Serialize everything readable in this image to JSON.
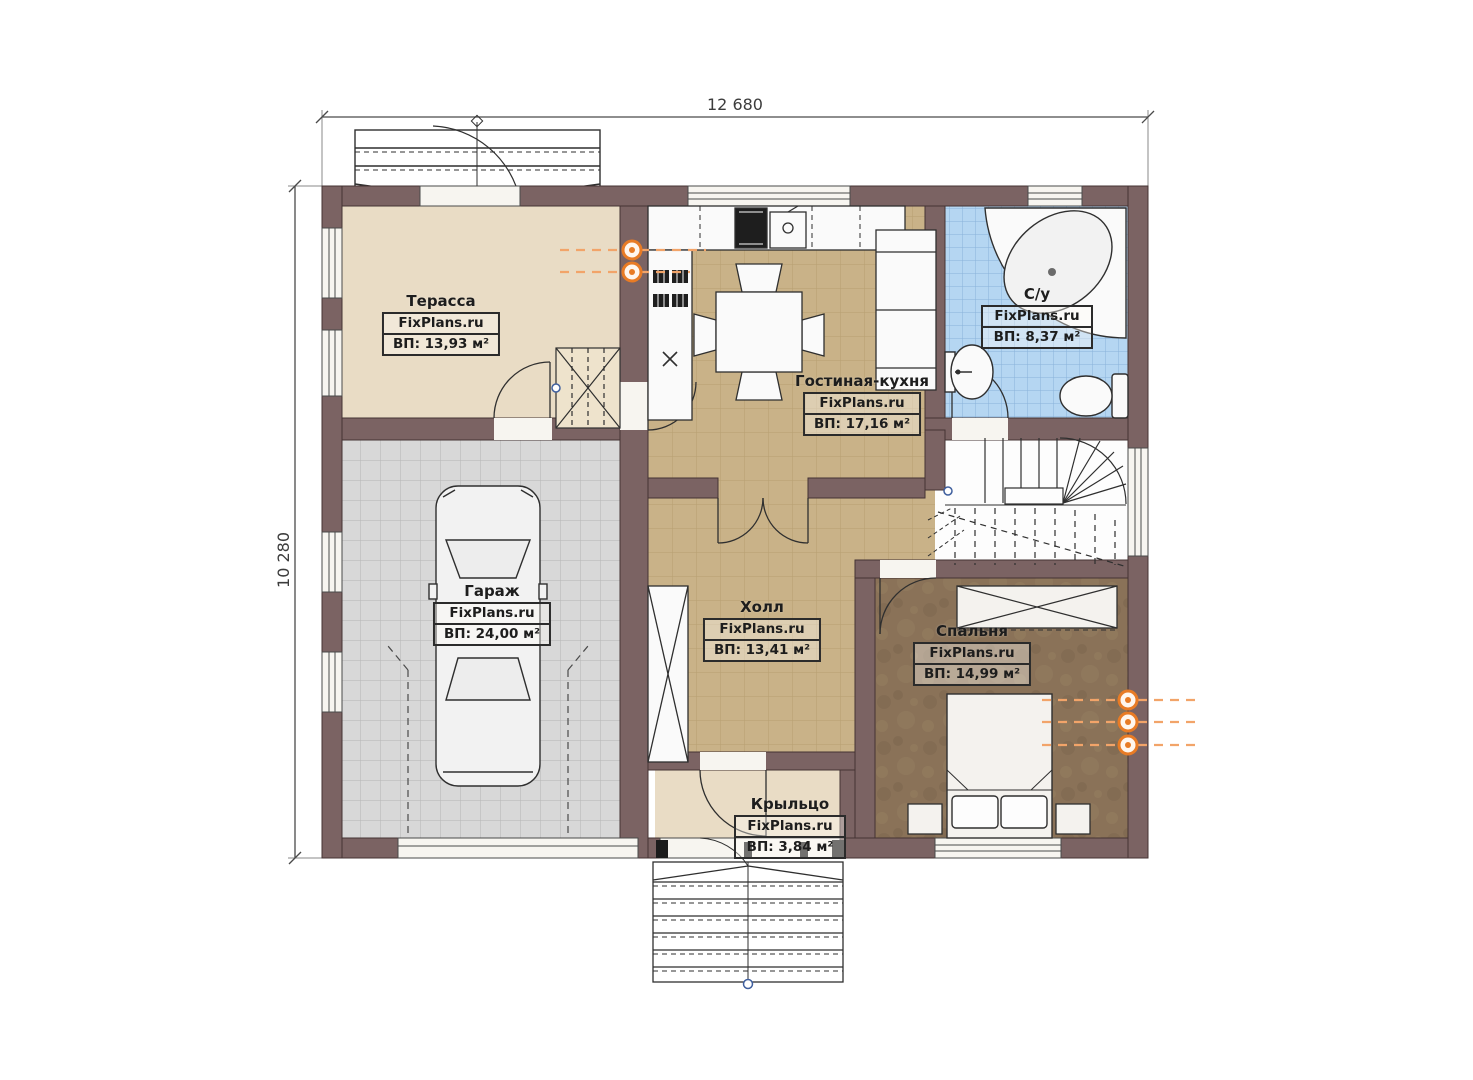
{
  "plan": {
    "type": "first-floor-plan",
    "dimensions": {
      "width_label": "12 680",
      "height_label": "10 280"
    },
    "rooms": [
      {
        "name": "Терасса",
        "brand": "FixPlans.ru",
        "area": "ВП: 13,93 м²"
      },
      {
        "name": "Гостиная-кухня",
        "brand": "FixPlans.ru",
        "area": "ВП: 17,16 м²"
      },
      {
        "name": "С/у",
        "brand": "FixPlans.ru",
        "area": "ВП: 8,37 м²"
      },
      {
        "name": "Гараж",
        "brand": "FixPlans.ru",
        "area": "ВП: 24,00 м²"
      },
      {
        "name": "Холл",
        "brand": "FixPlans.ru",
        "area": "ВП: 13,41 м²"
      },
      {
        "name": "Спальня",
        "brand": "FixPlans.ru",
        "area": "ВП: 14,99 м²"
      },
      {
        "name": "Крыльцо",
        "brand": "FixPlans.ru",
        "area": "ВП: 3,84 м²"
      }
    ],
    "colors": {
      "wall": "#7b6363",
      "floor_wood": "#c9b288",
      "floor_terrace": "#e9dcc5",
      "floor_garage": "#d8d8d8",
      "floor_bath": "#b5d6f2",
      "floor_bedroom": "#8a7258",
      "marker_orange": "#e87b25"
    }
  }
}
